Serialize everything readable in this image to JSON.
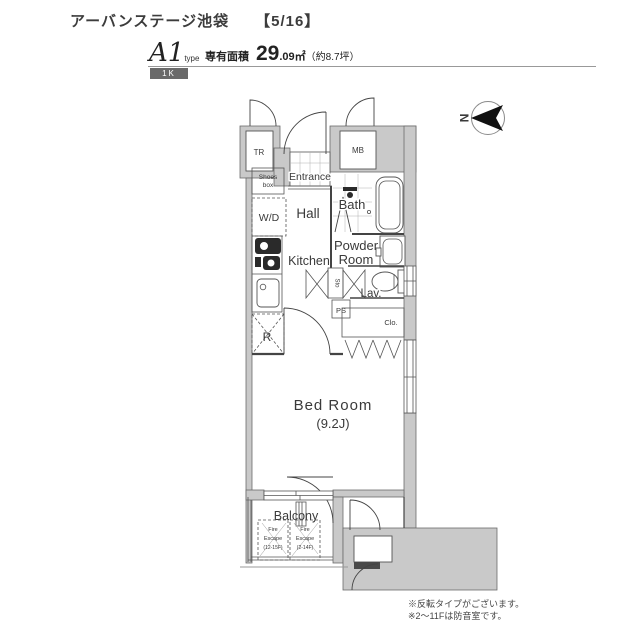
{
  "header": {
    "title": "アーバンステージ池袋",
    "page": "【5/16】",
    "type_code": "A1",
    "type_suffix": "type",
    "layout": "1K",
    "area_label": "専有面積",
    "area_int": "29",
    "area_frac": ".09㎡",
    "area_tsubo": "（約8.7坪）"
  },
  "compass": {
    "north": "N"
  },
  "rooms": {
    "tr": "TR",
    "mb": "MB",
    "entrance": "Entrance",
    "shoes_line1": "Shoes",
    "shoes_line2": "box",
    "wd": "W/D",
    "hall": "Hall",
    "bath": "Bath",
    "kitchen": "Kitchen",
    "powder_line1": "Powder",
    "powder_line2": "Room",
    "sto": "Sto",
    "lav": "Lav.",
    "ps": "PS",
    "fridge": "R",
    "closet": "Clo.",
    "bedroom": "Bed Room",
    "bedroom_size": "(9.2J)",
    "balcony": "Balcony"
  },
  "fire_escape": {
    "hatch1_line1": "Fire",
    "hatch1_line2": "Escape",
    "hatch1_line3": "(12-15F)",
    "hatch2_line1": "Fire",
    "hatch2_line2": "Escape",
    "hatch2_line3": "(2-14F)"
  },
  "notes": {
    "line1": "※反転タイプがございます。",
    "line2": "※2～11Fは防音室です。"
  },
  "colors": {
    "wall_fill": "#c9c9c9",
    "line": "#444444",
    "badge_bg": "#6a6a6a"
  }
}
